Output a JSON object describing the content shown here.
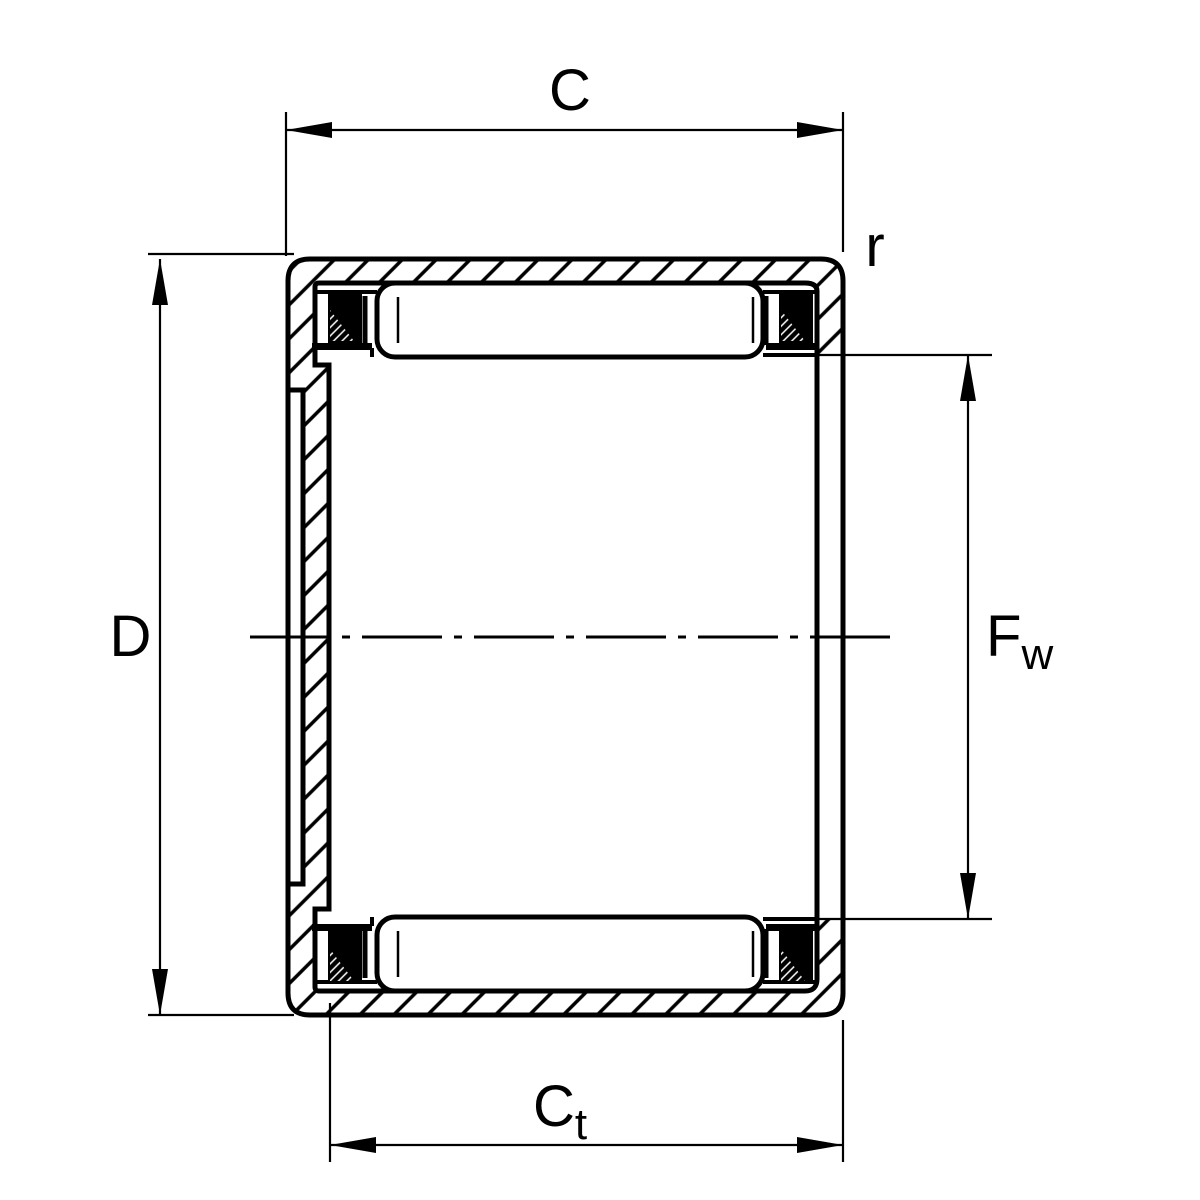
{
  "diagram": {
    "description_labels": {
      "outer_width_c": "C",
      "outer_diameter_d": "D",
      "bore_diameter_f": "F",
      "bore_diameter_f_sub": "w",
      "total_width_c": "C",
      "total_width_c_sub": "t",
      "corner_radius_r": "r"
    },
    "colors": {
      "line": "#000000",
      "background": "#ffffff"
    }
  }
}
